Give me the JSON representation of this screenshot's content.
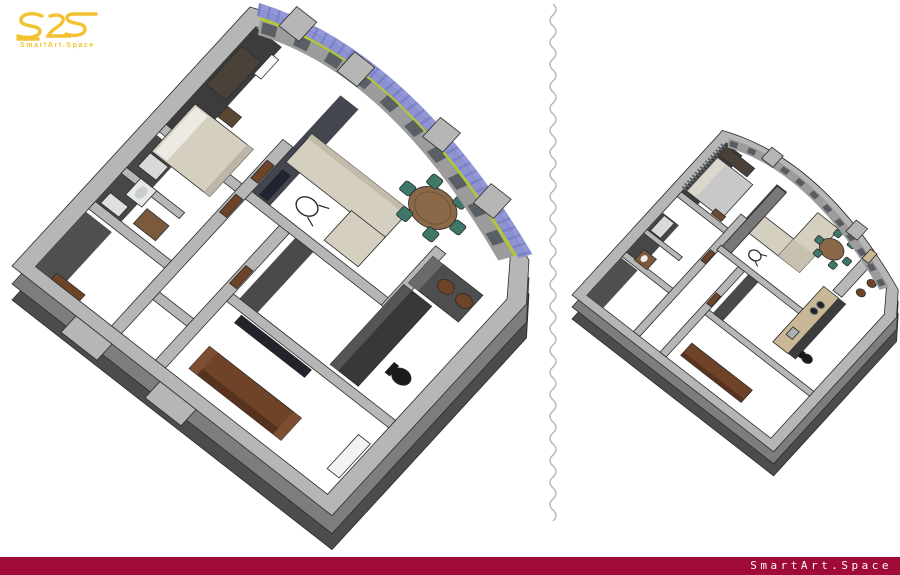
{
  "brand": {
    "logo_mark": "S2S",
    "logo_subtext": "SmartArt.Space"
  },
  "footer": {
    "brand_text": "SmartArt.Space"
  },
  "renders": {
    "left": {
      "name": "apartment-3d-cutaway-floorplan-large"
    },
    "right": {
      "name": "apartment-3d-cutaway-floorplan-small"
    }
  },
  "colors": {
    "accent_red": "#A00A36",
    "logo_gold": "#F2C230",
    "divider_gray": "#b4b4b4",
    "wall_top": "#b6b6b6",
    "wall_face": "#7d7d7d",
    "wall_face_dark": "#4c4c4c",
    "wall_inner_dark": "#3f3f3f",
    "floor": "#ffffff",
    "sofa_beige": "#d5cfc0",
    "sofa_brown": "#6e4328",
    "table_wood": "#8a6848",
    "chair_teal": "#3d7868",
    "curtain_blue": "#8a90d4",
    "trim_lime": "#b5c832",
    "counter_beige": "#c9b795",
    "chair_black": "#1b1b1b"
  }
}
